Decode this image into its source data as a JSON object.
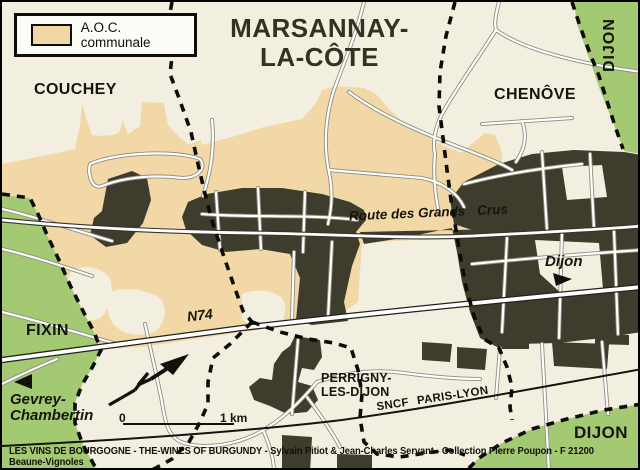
{
  "legend": {
    "label": "A.O.C. communale"
  },
  "title": {
    "line1": "MARSANNAY-",
    "line2": "LA-CÔTE"
  },
  "places": {
    "couchey": "COUCHEY",
    "chenove": "CHENÔVE",
    "dijon_top": "DIJON",
    "dijon_bottom": "DIJON",
    "fixin": "FIXIN",
    "gevrey": {
      "line1": "Gevrey-",
      "line2": "Chambertin"
    },
    "perrigny": {
      "line1": "PERRIGNY-",
      "line2": "LES-DIJON"
    },
    "dijon_direction": "Dijon"
  },
  "roads": {
    "grands_crus_a": "Route des Grands",
    "grands_crus_b": "Crus",
    "n74": "N74",
    "railway": "SNCF PARIS-LYON"
  },
  "scale": {
    "zero": "0",
    "one_km": "1 km"
  },
  "caption": "LES VINS DE BOURGOGNE - THE-WINES OF BURGUNDY - Sylvain Pitiot & Jean-Charles Servant - Collection Pierre Poupon - F 21200 Beaune-Vignoles",
  "colors": {
    "aoc_fill": "#f2d8a6",
    "vineyard_green": "#a4c973",
    "built_area": "#3e3c2d",
    "background": "#f2efe1"
  }
}
